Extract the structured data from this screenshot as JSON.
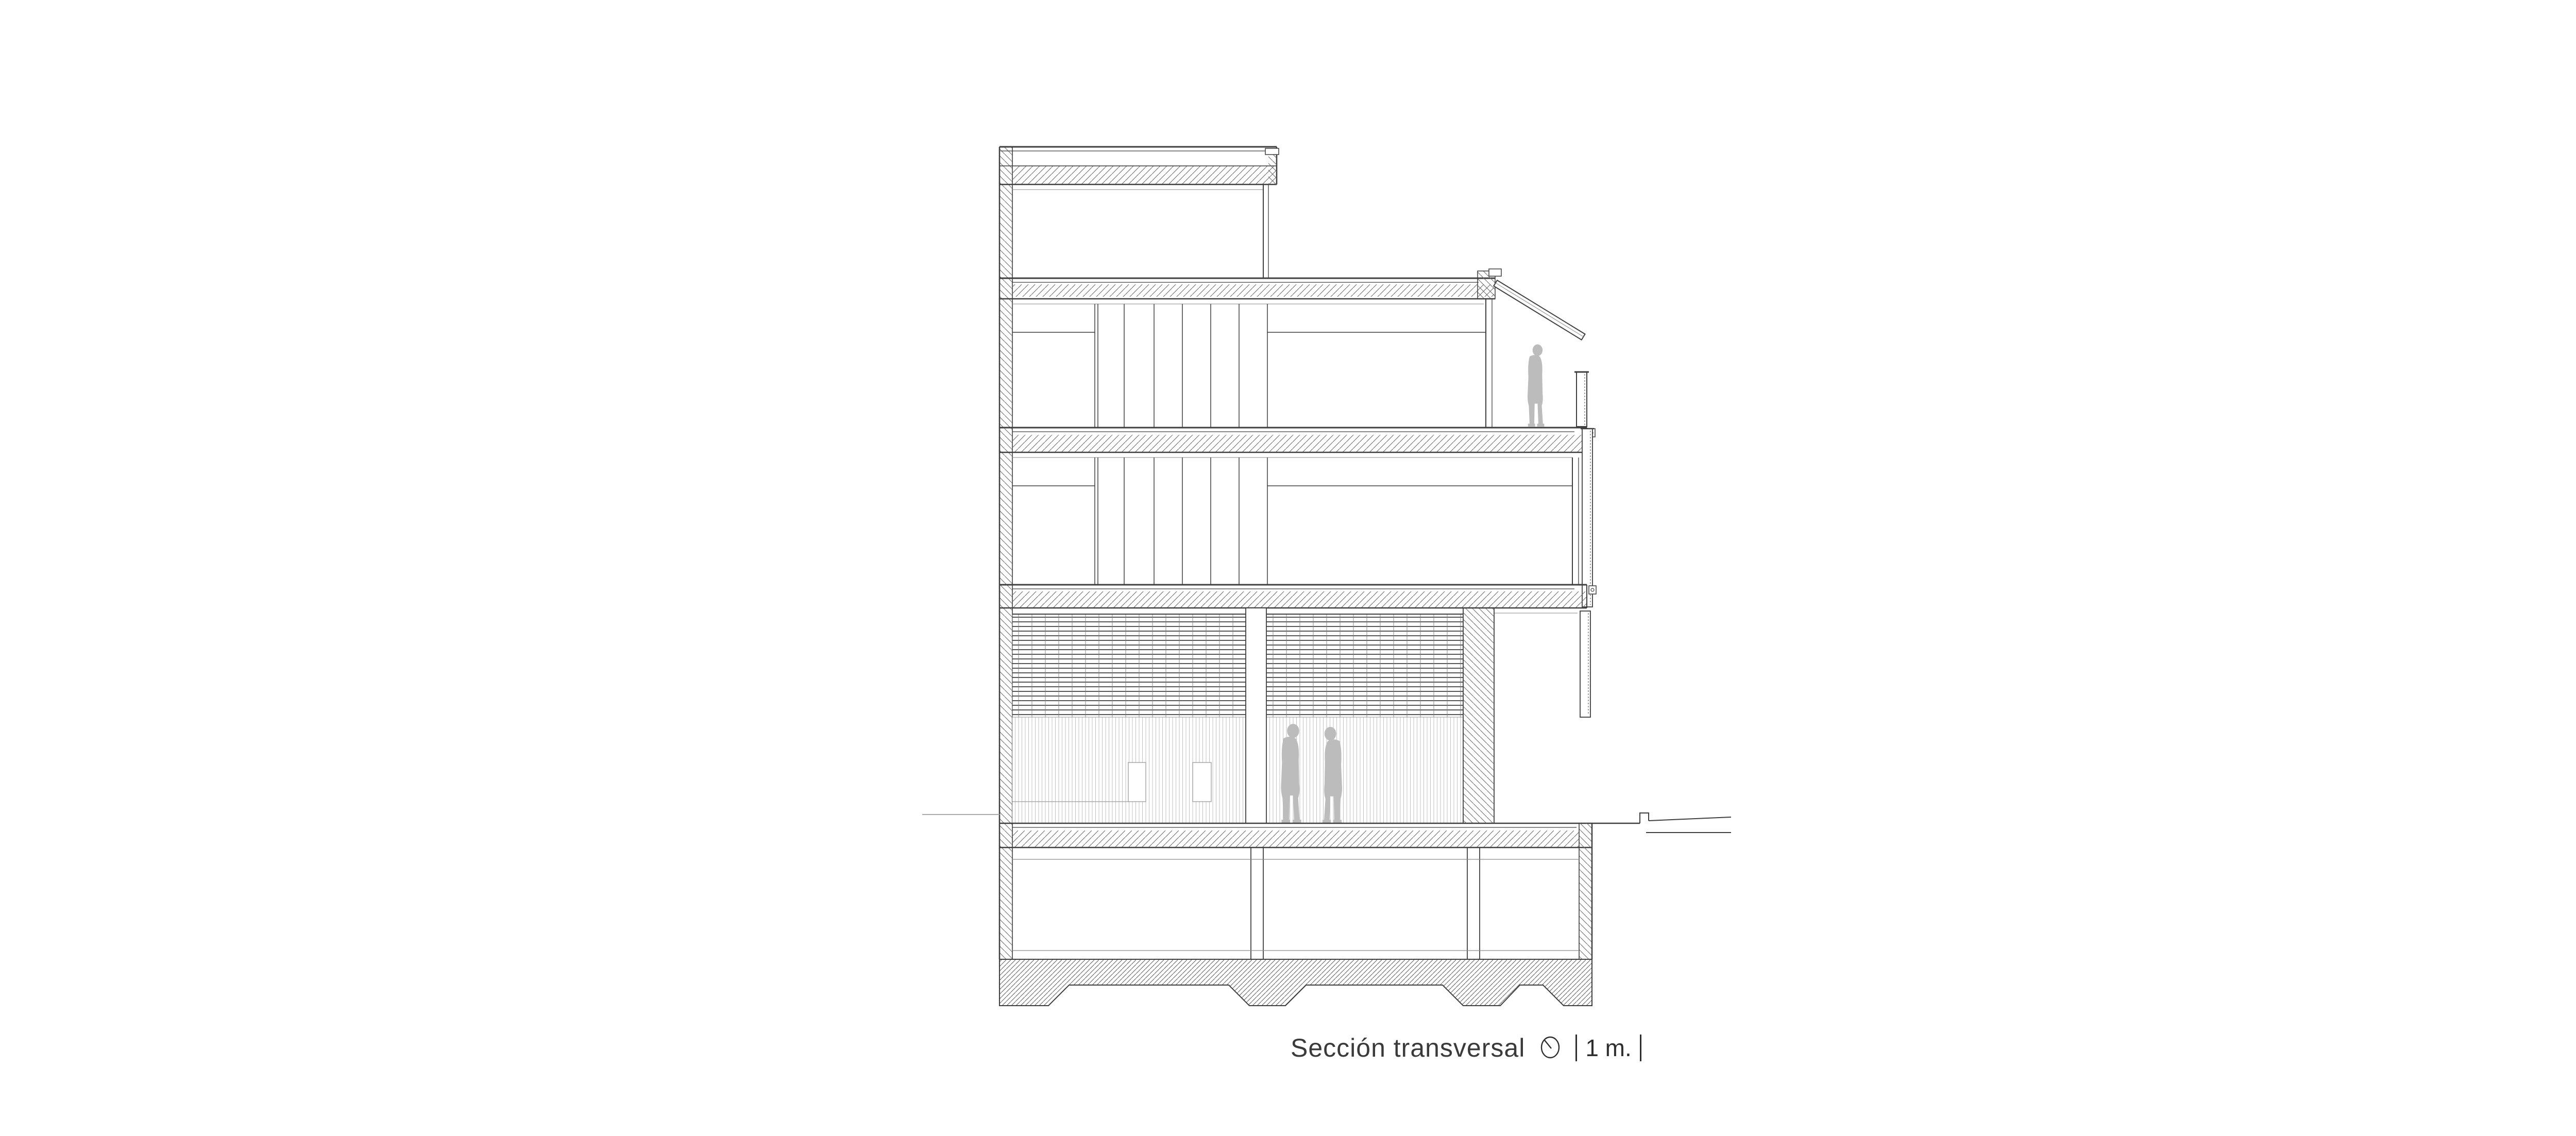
{
  "drawing": {
    "title": "Sección transversal",
    "scale_label": "1 m.",
    "kind": "architectural cross-section"
  },
  "symbols": {
    "north_indicator": "north-circle-icon"
  },
  "figures": {
    "terrace_person": "standing silhouette on upper terrace",
    "ground_people": "two standing silhouettes talking on ground floor"
  },
  "colors": {
    "line": "#3f3f3f",
    "light_line": "#8a8a8a",
    "ground_line": "#adadad",
    "people": "#bcbcbc",
    "background": "#ffffff"
  }
}
